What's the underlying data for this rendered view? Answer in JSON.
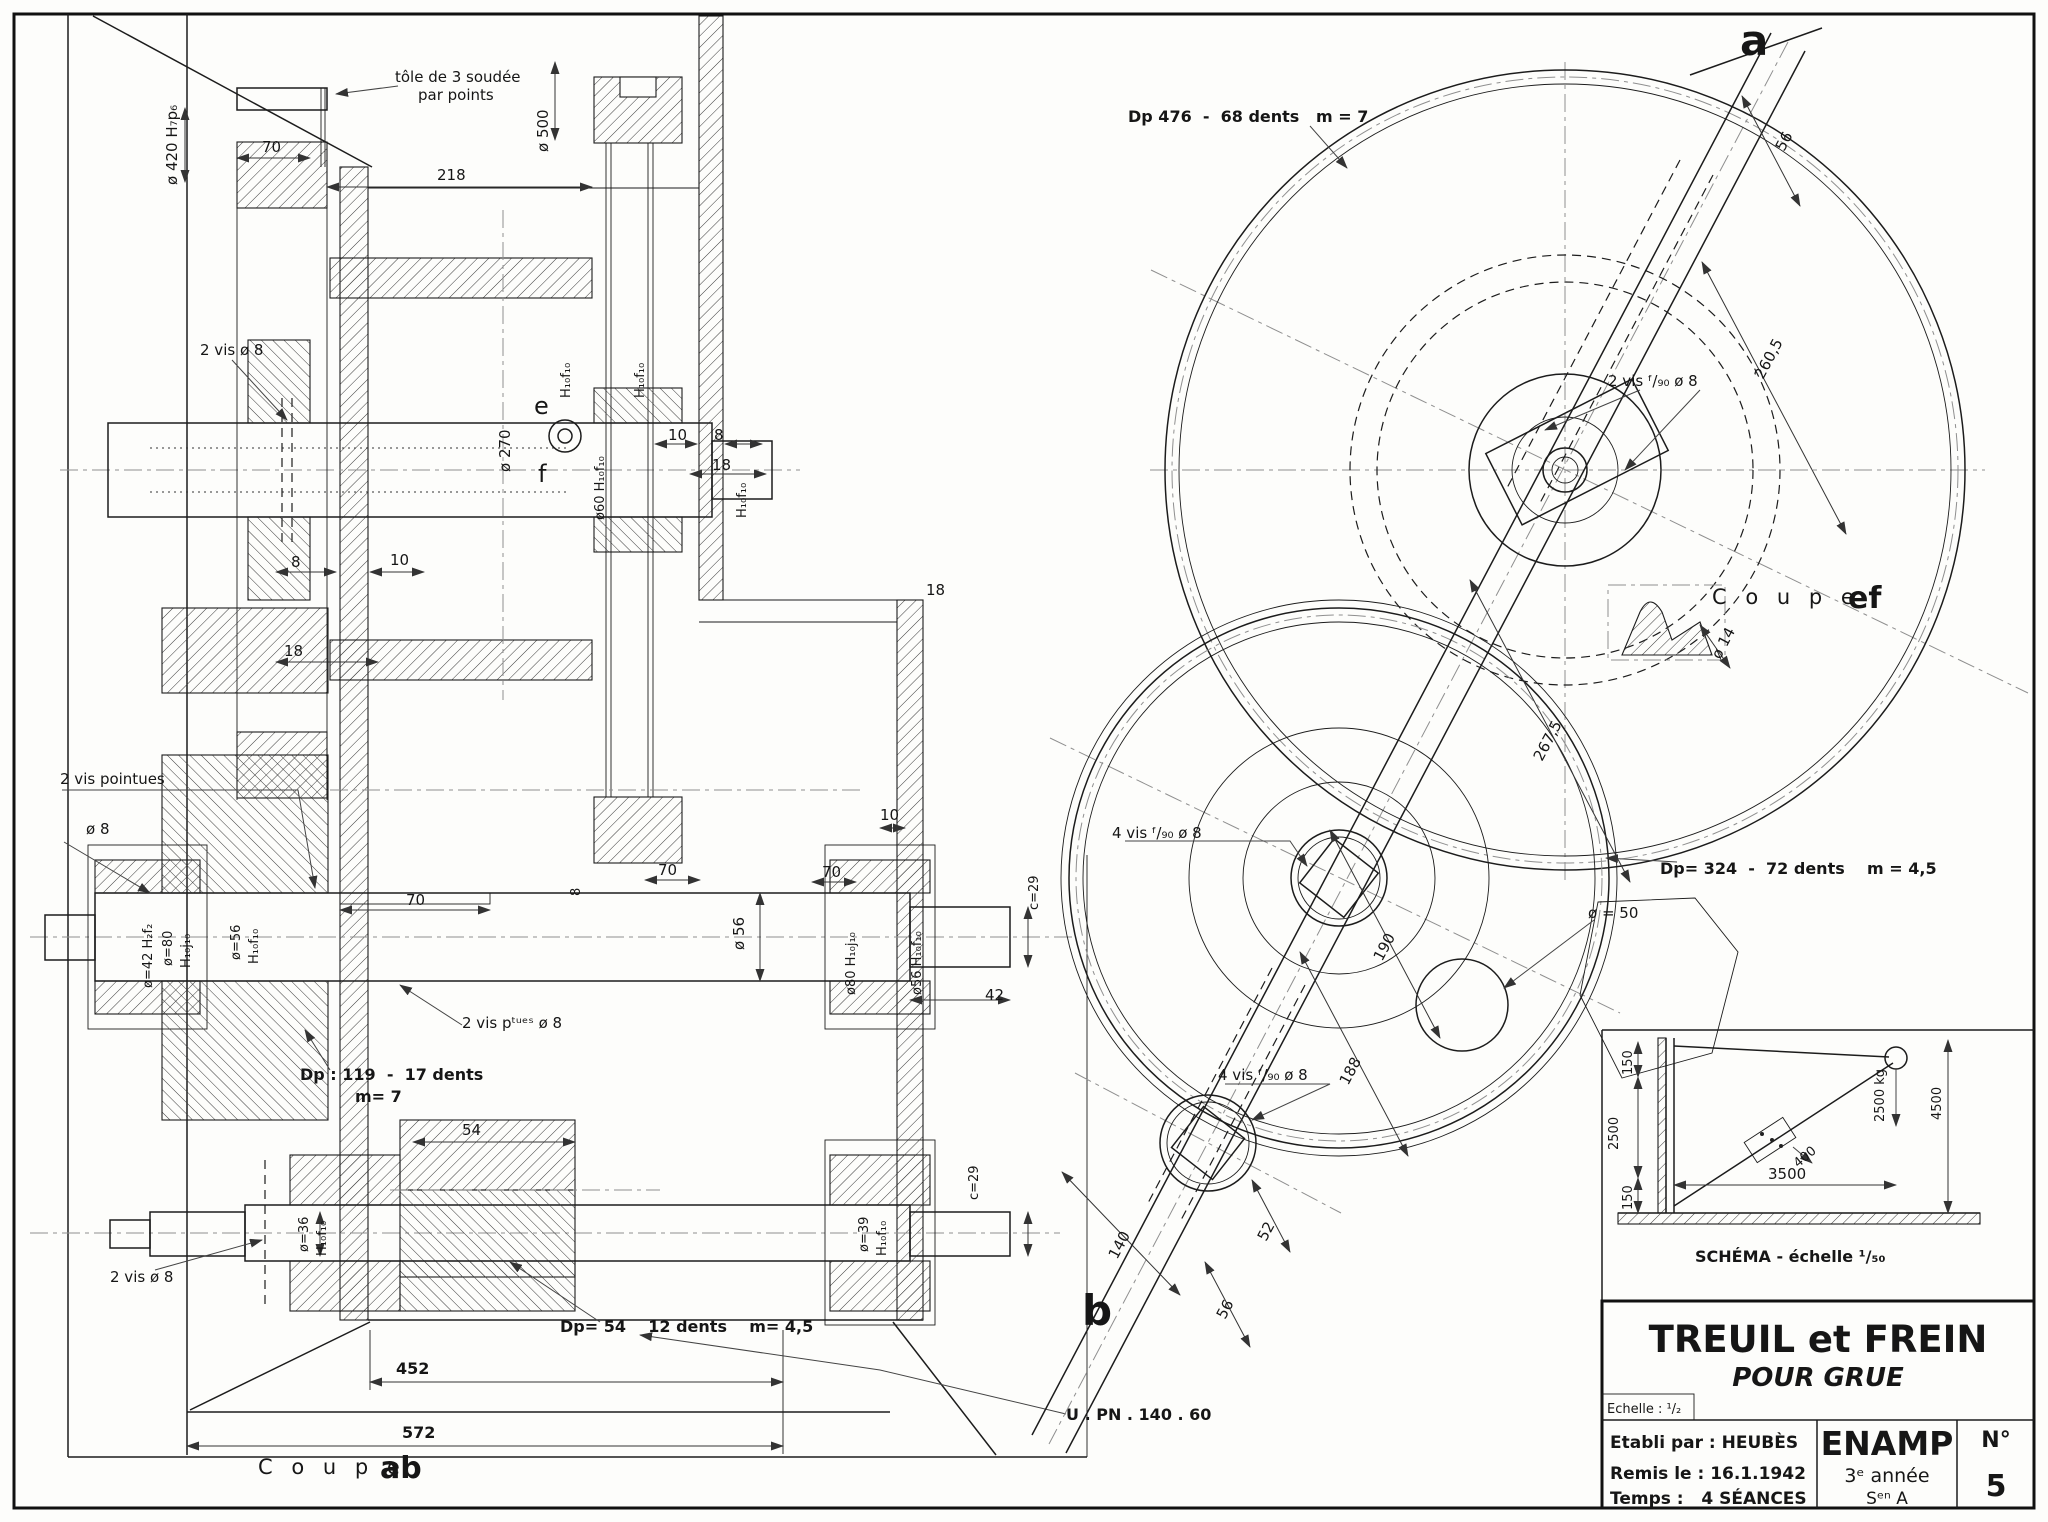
{
  "drawing": {
    "type": "mechanical section drawing",
    "sheet_title": "TREUIL et FREIN",
    "sheet_subtitle": "POUR GRUE"
  },
  "left_view": {
    "tole1": "tôle de 3 soudée",
    "tole2": "par points",
    "d420": "ø 420 H₇p₆",
    "d70a": "70",
    "d218": "218",
    "d500": "ø 500",
    "d270": "ø 270",
    "vis2a": "2 vis ø 8",
    "d60": "ø60 H₁₀f₁₀",
    "hf1": "H₁₀f₁₀",
    "hf2": "H₁₀f₁₀",
    "hf3": "H₁₀f₁₀",
    "e": "e",
    "f": "f",
    "w8a": "8",
    "w10a": "10",
    "w18a": "18",
    "w10b": "10",
    "w8b": "8",
    "w18b": "18",
    "visp1": "2 vis pointues",
    "visp2": "ø 8",
    "d42fit": "ø=42 H₂f₂",
    "d80a": "ø=80",
    "hj10": "H₁₀j₁₀",
    "d56a": "ø=56",
    "hf4": "H₁₀f₁₀",
    "d70b": "70",
    "k8": "8",
    "d56b": "ø 56",
    "d70c": "70",
    "d70d": "70",
    "w18c": "18",
    "w10c": "10",
    "visptues": "2 vis pᵗᵘᵉˢ ø 8",
    "d80b": "ø80 H₁₀j₁₀",
    "d56c": "ø56 H₁₀f₁₀",
    "c29a": "c=29",
    "d42b": "42",
    "dp119a": "Dp : 119  -  17 dents",
    "dp119b": "m= 7",
    "d54": "54",
    "d36": "ø=36",
    "hf5": "H₁₀f₁₀",
    "vis2b": "2 vis ø 8",
    "d39": "ø=39",
    "hf6": "H₁₀f₁₀",
    "c29b": "c=29",
    "dp54": "Dp= 54    12 dents    m= 4,5",
    "d452": "452",
    "d572": "572",
    "coupe": "C o u p e",
    "coupe_ab": "ab",
    "upn": "U . PN . 140 . 60"
  },
  "right_view": {
    "a": "a",
    "b": "b",
    "dp476": "Dp 476  -  68 dents   m = 7",
    "d56r": "56",
    "vis2c": "2 vis ᶠ/₉₀ ø 8",
    "d2605": "260,5",
    "coupe_ef1": "C o u p e",
    "coupe_ef2": "ef",
    "d14": "ø 14",
    "d2675": "267,5",
    "dp324": "Dp= 324  -  72 dents    m = 4,5",
    "d50": "ø = 50",
    "vis4a": "4 vis ᶠ/₉₀ ø 8",
    "vis4b": "4 vis ᶠ/₉₀ ø 8",
    "d190": "190",
    "d188": "188",
    "d52": "52",
    "d56s": "56",
    "d140": "140"
  },
  "schema": {
    "caption": "SCHÉMA - échelle ¹/₅₀",
    "s150a": "150",
    "s2500": "2500",
    "s150b": "150",
    "s3500": "3500",
    "s400": "400",
    "s2500kg": "2500 kg",
    "s4500": "4500"
  },
  "title_block": {
    "title": "TREUIL et FREIN",
    "subtitle": "POUR GRUE",
    "echelle": "Echelle : ¹/₂",
    "etabli": "Etabli par : HEUBÈS",
    "remis": "Remis le : 16.1.1942",
    "temps": "Temps :   4 SÉANCES",
    "school": "ENAMP",
    "year": "3ᵉ année",
    "section": "Sᵉⁿ A",
    "num_label": "N°",
    "num": "5"
  }
}
